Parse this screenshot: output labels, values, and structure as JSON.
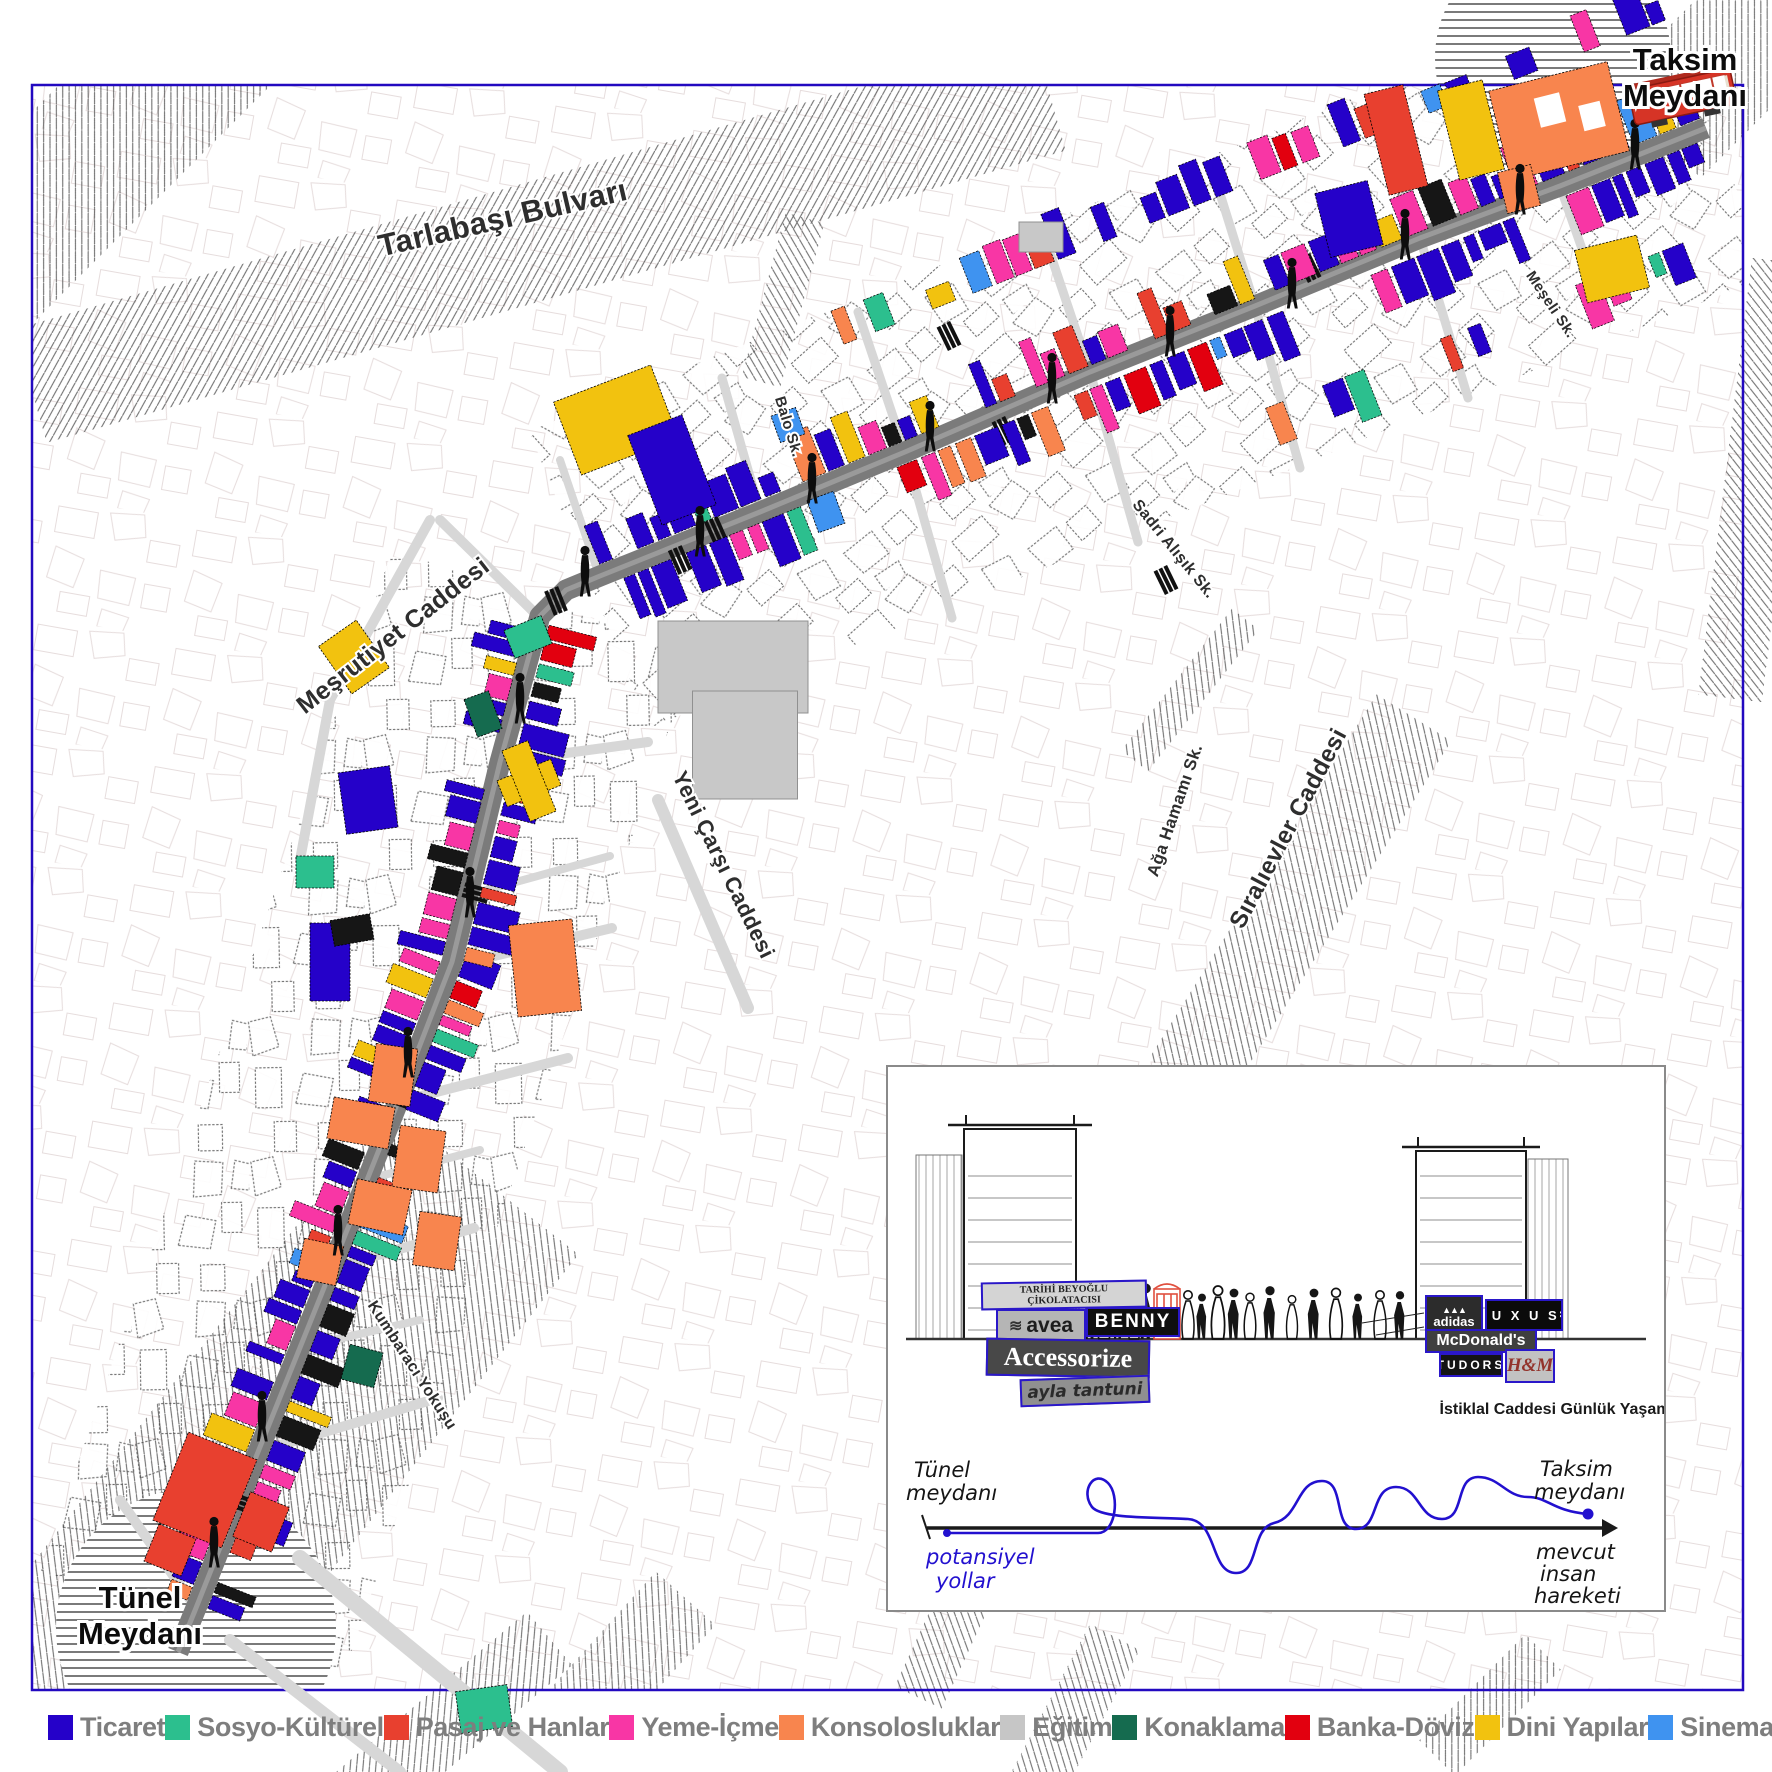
{
  "map": {
    "labels": {
      "taksim1": "Taksim",
      "taksim2": "Meydanı",
      "tunel1": "Tünel",
      "tunel2": "Meydanı"
    },
    "streets": [
      {
        "id": "tarlabasi",
        "label": "Tarlabaşı Bulvarı",
        "x": 505,
        "y": 228,
        "rot": -13,
        "size": 31
      },
      {
        "id": "mesrutiyet",
        "label": "Meşrutiyet Caddesi",
        "x": 398,
        "y": 642,
        "rot": -38,
        "size": 25
      },
      {
        "id": "yenicarsi",
        "label": "Yeni Çarşı Caddesi",
        "x": 717,
        "y": 868,
        "rot": 64,
        "size": 22
      },
      {
        "id": "kumbaraci",
        "label": "Kumbaracı Yokuşu",
        "x": 408,
        "y": 1368,
        "rot": 57,
        "size": 16
      },
      {
        "id": "balo",
        "label": "Balo Sk.",
        "x": 784,
        "y": 428,
        "rot": 73,
        "size": 15
      },
      {
        "id": "sadri",
        "label": "Sadri Alışık Sk.",
        "x": 1170,
        "y": 552,
        "rot": 51,
        "size": 16
      },
      {
        "id": "meseli",
        "label": "Meşeli Sk.",
        "x": 1547,
        "y": 307,
        "rot": 56,
        "size": 15
      },
      {
        "id": "aga",
        "label": "Ağa Hamamı Sk.",
        "x": 1180,
        "y": 812,
        "rot": -71,
        "size": 17
      },
      {
        "id": "sirali",
        "label": "Sıralıevler Caddesi",
        "x": 1295,
        "y": 832,
        "rot": -62,
        "size": 24
      }
    ],
    "palette": {
      "blue": "#2501c9",
      "green": "#2cbf8e",
      "red": "#e8402f",
      "pink": "#f836a5",
      "orange": "#f8854e",
      "gray": "#c8c8c8",
      "darkgreen": "#156b4f",
      "purered": "#e2000f",
      "yellow": "#f2c20f",
      "lightblue": "#3f93f0",
      "black": "#161616",
      "white": "#ffffff"
    },
    "strips": [
      [
        196,
        1608,
        452,
        962,
        1,
        11,
        0,
        11
      ],
      [
        196,
        1608,
        452,
        962,
        -1,
        11,
        0,
        22
      ],
      [
        452,
        962,
        540,
        616,
        1,
        11,
        0,
        33
      ],
      [
        452,
        962,
        540,
        616,
        -1,
        11,
        0,
        44
      ],
      [
        600,
        576,
        1700,
        130,
        1,
        11,
        0,
        55
      ],
      [
        600,
        576,
        1700,
        130,
        -1,
        11,
        0,
        66
      ],
      [
        860,
        396,
        1696,
        66,
        1,
        54,
        0.35,
        77
      ],
      [
        1140,
        400,
        1690,
        182,
        -1,
        54,
        0.4,
        88
      ]
    ],
    "landmarks": [
      [
        616,
        420,
        104,
        78,
        -21,
        "yellow"
      ],
      [
        672,
        470,
        58,
        96,
        -21,
        "blue"
      ],
      [
        733,
        667,
        150,
        92,
        0,
        "gray"
      ],
      [
        745,
        745,
        105,
        108,
        0,
        "gray"
      ],
      [
        1041,
        237,
        44,
        30,
        0,
        "gray"
      ],
      [
        529,
        783,
        58,
        28,
        -22,
        "yellow"
      ],
      [
        529,
        781,
        28,
        76,
        -22,
        "yellow"
      ],
      [
        354,
        657,
        46,
        58,
        -35,
        "yellow"
      ],
      [
        545,
        968,
        64,
        92,
        -6,
        "orange"
      ],
      [
        393,
        1075,
        42,
        58,
        8,
        "orange"
      ],
      [
        361,
        1123,
        62,
        42,
        10,
        "orange"
      ],
      [
        419,
        1159,
        46,
        62,
        8,
        "orange"
      ],
      [
        380,
        1207,
        56,
        46,
        12,
        "orange"
      ],
      [
        437,
        1241,
        42,
        54,
        8,
        "orange"
      ],
      [
        320,
        1262,
        40,
        40,
        12,
        "orange"
      ],
      [
        205,
        1490,
        74,
        95,
        22,
        "red"
      ],
      [
        261,
        1522,
        42,
        48,
        22,
        "red"
      ],
      [
        170,
        1550,
        40,
        40,
        22,
        "red"
      ],
      [
        528,
        637,
        40,
        30,
        -22,
        "green"
      ],
      [
        315,
        872,
        38,
        32,
        0,
        "green"
      ],
      [
        484,
        1709,
        52,
        42,
        -8,
        "green"
      ],
      [
        362,
        1366,
        34,
        36,
        15,
        "darkgreen"
      ],
      [
        483,
        714,
        26,
        40,
        -20,
        "darkgreen"
      ],
      [
        1396,
        140,
        40,
        104,
        -14,
        "red"
      ],
      [
        1471,
        130,
        46,
        92,
        -14,
        "yellow"
      ],
      [
        1559,
        121,
        122,
        92,
        -14,
        "orange"
      ],
      [
        1519,
        189,
        34,
        42,
        -14,
        "orange"
      ],
      [
        1612,
        269,
        64,
        54,
        -14,
        "yellow"
      ],
      [
        1349,
        219,
        54,
        66,
        -14,
        "blue"
      ],
      [
        1550,
        110,
        26,
        30,
        -14,
        "white"
      ],
      [
        1592,
        116,
        22,
        26,
        -14,
        "white"
      ],
      [
        368,
        800,
        52,
        62,
        -8,
        "blue"
      ],
      [
        330,
        962,
        40,
        78,
        0,
        "blue"
      ],
      [
        352,
        930,
        40,
        26,
        -10,
        "black"
      ],
      [
        788,
        425,
        26,
        28,
        -20,
        "lightblue"
      ],
      [
        826,
        512,
        28,
        34,
        -20,
        "lightblue"
      ]
    ],
    "corridors": [
      [
        368,
        1112,
        1080,
        320,
        -71
      ],
      [
        1150,
        353,
        1210,
        320,
        -22
      ]
    ],
    "hatches": [
      [
        540,
        240,
        1060,
        118,
        -16,
        1
      ],
      [
        120,
        130,
        420,
        150,
        -45,
        1
      ],
      [
        1757,
        480,
        440,
        64,
        -83,
        0
      ],
      [
        250,
        1480,
        760,
        240,
        -52,
        1
      ],
      [
        450,
        1722,
        260,
        70,
        -40,
        0
      ],
      [
        952,
        1625,
        160,
        52,
        -65,
        0
      ],
      [
        1075,
        1712,
        170,
        56,
        -62,
        0
      ],
      [
        1300,
        900,
        430,
        88,
        -58,
        1
      ],
      [
        1490,
        1705,
        150,
        50,
        -45,
        0
      ],
      [
        783,
        300,
        170,
        40,
        -75,
        1
      ],
      [
        1190,
        690,
        180,
        34,
        -52,
        1
      ],
      [
        1729,
        58,
        210,
        130,
        -45,
        0
      ],
      [
        612,
        1680,
        220,
        80,
        -48,
        1
      ]
    ],
    "sideStreets": [
      [
        258,
        1452,
        438,
        1398,
        10
      ],
      [
        332,
        1268,
        474,
        1228,
        10
      ],
      [
        398,
        1102,
        568,
        1058,
        10
      ],
      [
        452,
        966,
        612,
        928,
        10
      ],
      [
        500,
        762,
        648,
        742,
        10
      ],
      [
        540,
        618,
        440,
        520,
        10
      ],
      [
        600,
        578,
        560,
        460,
        8
      ],
      [
        760,
        512,
        722,
        378,
        9
      ],
      [
        905,
        452,
        858,
        312,
        9
      ],
      [
        905,
        452,
        952,
        618,
        9
      ],
      [
        1090,
        372,
        1043,
        232,
        9
      ],
      [
        1090,
        372,
        1138,
        542,
        9
      ],
      [
        1255,
        306,
        1212,
        168,
        9
      ],
      [
        1255,
        306,
        1300,
        468,
        9
      ],
      [
        1420,
        238,
        1378,
        112,
        9
      ],
      [
        1420,
        238,
        1468,
        398,
        9
      ],
      [
        1560,
        186,
        1600,
        300,
        9
      ],
      [
        300,
        1558,
        560,
        1772,
        16
      ],
      [
        230,
        1640,
        400,
        1772,
        12
      ],
      [
        196,
        1608,
        120,
        1500,
        10
      ],
      [
        476,
        893,
        610,
        856,
        8
      ],
      [
        365,
        1180,
        480,
        1150,
        8
      ],
      [
        290,
        1350,
        420,
        1320,
        8
      ],
      [
        430,
        520,
        330,
        700,
        10
      ],
      [
        330,
        700,
        300,
        860,
        10
      ],
      [
        658,
        800,
        748,
        1008,
        12
      ]
    ],
    "crosswalks": [
      [
        250,
        1506,
        19
      ],
      [
        398,
        1098,
        19
      ],
      [
        476,
        893,
        15
      ],
      [
        556,
        601,
        68
      ],
      [
        716,
        531,
        66
      ],
      [
        949,
        336,
        64
      ],
      [
        1004,
        431,
        64
      ],
      [
        1166,
        580,
        64
      ],
      [
        1309,
        268,
        64
      ],
      [
        680,
        560,
        66
      ]
    ],
    "people": [
      [
        214,
        1556
      ],
      [
        262,
        1430
      ],
      [
        338,
        1244
      ],
      [
        408,
        1066
      ],
      [
        470,
        906
      ],
      [
        520,
        712
      ],
      [
        585,
        585
      ],
      [
        700,
        545
      ],
      [
        812,
        492
      ],
      [
        930,
        440
      ],
      [
        1052,
        392
      ],
      [
        1170,
        345
      ],
      [
        1292,
        297
      ],
      [
        1405,
        248
      ],
      [
        1520,
        203
      ],
      [
        1635,
        158
      ]
    ]
  },
  "legend": {
    "items": [
      {
        "label": "Ticaret",
        "color": "#2501c9"
      },
      {
        "label": "Sosyo-Kültürel",
        "color": "#2cbf8e"
      },
      {
        "label": "Pasaj ve Hanlar",
        "color": "#e8402f"
      },
      {
        "label": "Yeme-İçme",
        "color": "#f836a5"
      },
      {
        "label": "Konsolosluklar",
        "color": "#f8854e"
      },
      {
        "label": "Eğitim",
        "color": "#c6c6c6"
      },
      {
        "label": "Konaklama",
        "color": "#156b4f"
      },
      {
        "label": "Banka-Döviz",
        "color": "#e2000f"
      },
      {
        "label": "Dini Yapılar",
        "color": "#f2c20f"
      },
      {
        "label": "Sinema",
        "color": "#3f93f0"
      },
      {
        "label": "Kullanılmayan",
        "color": "#111111",
        "dark": true
      }
    ]
  },
  "inset": {
    "caption": "İstiklal Caddesi Günlük Yaşam",
    "signs": {
      "tarihi1": "TARİHİ BEYOĞLU",
      "tarihi2": "ÇİKOLATACISI",
      "avea": "avea",
      "benny": "BENNY",
      "accessorize": "Accessorize",
      "ayla": "ayla tantuni",
      "adidas": "adidas",
      "luxus": "L U X U S",
      "mcdonalds": "McDonald's",
      "tudors": "TUDORS",
      "hm": "H&M"
    },
    "diagram": {
      "tunel1": "Tünel",
      "tunel2": "meydanı",
      "pot1": "potansiyel",
      "pot2": "yollar",
      "taksim1": "Taksim",
      "taksim2": "meydanı",
      "mev1": "mevcut",
      "mev2": "insan",
      "mev3": "hareketi"
    }
  }
}
